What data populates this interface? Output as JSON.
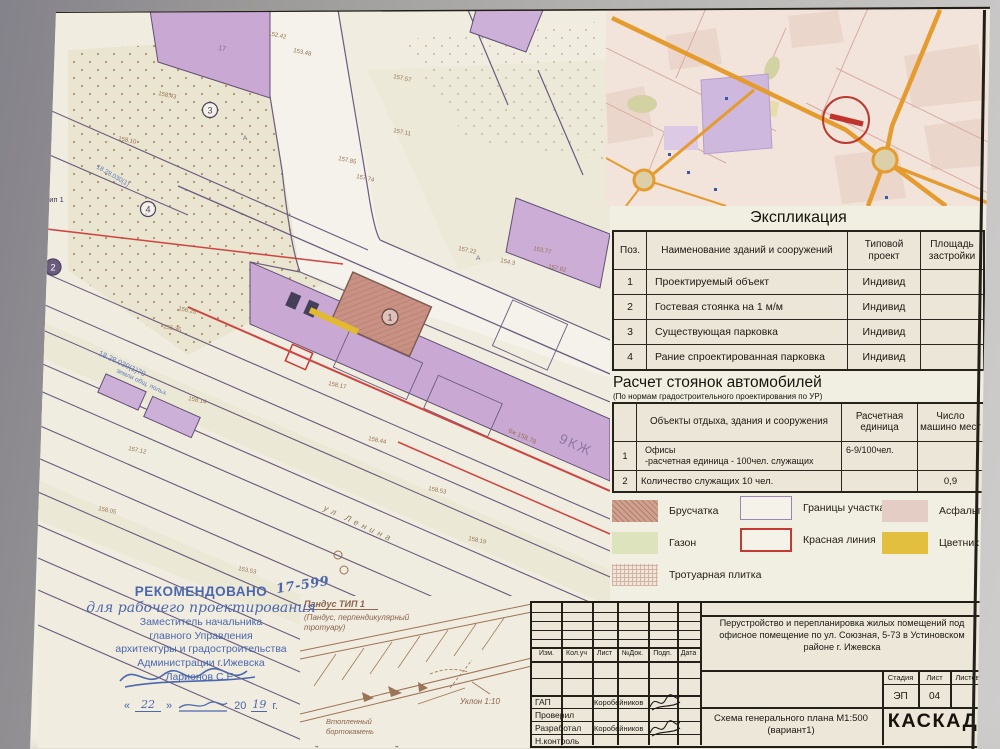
{
  "plan": {
    "label_ramp_left": "с тип 1",
    "building_band": "9КЖ",
    "building_17": "17",
    "street": "ул Ленина",
    "cadastral_main": "18.28.030(1)70",
    "cadastral_sub": "земли общ. польз.",
    "cadastral_upper": "18.28.030(1)",
    "note_6zh": "6ж 158.78",
    "letter_a": "А",
    "markers": {
      "m1": "1",
      "m2": "2",
      "m3": "3",
      "m4": "4"
    },
    "elevations": [
      "157.85",
      "157.74",
      "157.11",
      "158.43",
      "158.10",
      "157.57",
      "157.62",
      "153.77",
      "154.3",
      "158.17",
      "158.44",
      "158.53",
      "158.19",
      "152.42",
      "153.48",
      "157.12",
      "158.14",
      "156.25",
      "155.35",
      "157.22",
      "158.05",
      "153.53"
    ]
  },
  "ramp_detail": {
    "title": "Пандус ТИП 1",
    "subtitle_line1": "(Пандус, перпендикулярный",
    "subtitle_line2": "тротуару)",
    "slope": "Уклон 1:10",
    "curb_line1": "Втопленный",
    "curb_line2": "бортокамень"
  },
  "stamp": {
    "title": "РЕКОМЕНДОВАНО",
    "number": "17-599",
    "purpose": "для рабочего проектирования",
    "line1": "Заместитель начальника",
    "line2": "главного Управления",
    "line3": "архитектуры и градостроительства",
    "line4": "Администрации г.Ижевска",
    "signer": "Ларионов С.Е.",
    "quote_open": "«",
    "quote_close": "»",
    "date_day": "22",
    "year_prefix": "20",
    "date_year": "19",
    "year_suffix": "г."
  },
  "explication": {
    "title": "Экспликация",
    "headers": [
      "Поз.",
      "Наименование зданий и сооружений",
      "Типовой проект",
      "Площадь застройки"
    ],
    "rows": [
      {
        "pos": "1",
        "name": "Проектируемый объект",
        "project": "Индивид",
        "area": ""
      },
      {
        "pos": "2",
        "name": "Гостевая стоянка на 1 м/м",
        "project": "Индивид",
        "area": ""
      },
      {
        "pos": "3",
        "name": "Существующая парковка",
        "project": "Индивид",
        "area": ""
      },
      {
        "pos": "4",
        "name": "Рание спроектированная парковка",
        "project": "Индивид",
        "area": ""
      }
    ]
  },
  "parking": {
    "title": "Расчет стоянок автомобилей",
    "subtitle": "(По нормам градостроительного проектирования по УР)",
    "headers": [
      "",
      "Объекты отдыха, здания и сооружения",
      "Расчетная единица",
      "Число машино мест"
    ],
    "rows": [
      {
        "pos": "1",
        "name_line1": "Офисы",
        "name_line2": "-расчетная единица - 100чел. служащих",
        "unit": "6-9/100чел.",
        "count": ""
      },
      {
        "pos": "2",
        "name_line1": "Количество служащих 10 чел.",
        "name_line2": "",
        "unit": "",
        "count": "0,9"
      }
    ]
  },
  "legend": {
    "items": [
      "Брусчатка",
      "Газон",
      "Тротуарная плитка",
      "Границы участка",
      "Красная линия",
      "Асфальт",
      "Цветник"
    ]
  },
  "titleblock": {
    "cols": [
      "Изм.",
      "Кол.уч",
      "Лист",
      "№Док.",
      "Подп.",
      "Дата"
    ],
    "roles": [
      {
        "role": "ГАП",
        "name": "Коробейников"
      },
      {
        "role": "Проверил",
        "name": ""
      },
      {
        "role": "Разработал",
        "name": "Коробейников"
      },
      {
        "role": "Н.контроль",
        "name": ""
      }
    ],
    "project_title": "Перустройство и перепланировка жилых помещений под офисное помещение по ул. Союзная, 5-73 в Устиновском районе г. Ижевска",
    "stage_label": "Стадия",
    "sheet_label": "Лист",
    "sheets_label": "Листов",
    "stage": "ЭП",
    "sheet": "04",
    "sheets": "",
    "drawing_name": "Схема генерального плана М1:500",
    "drawing_variant": "(вариант1)",
    "company": "КАСКАД"
  },
  "colors": {
    "red_line": "#c23a30",
    "road_orange": "#e59b2e",
    "building_purple": "#c9a9d4",
    "paper": "#f1eee2",
    "stamp_blue": "#4b67ae"
  }
}
